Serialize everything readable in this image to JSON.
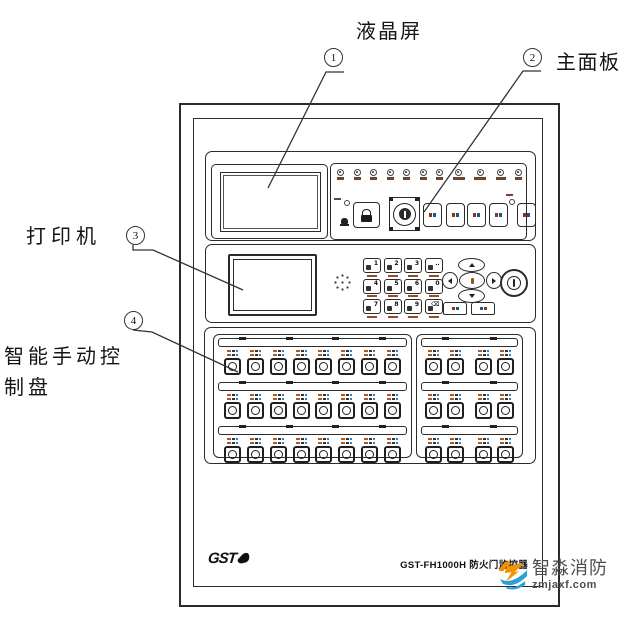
{
  "callouts": {
    "lcd": {
      "num": "1",
      "label": "液晶屏"
    },
    "main_panel": {
      "num": "2",
      "label": "主面板"
    },
    "printer": {
      "num": "3",
      "label": "打印机"
    },
    "manual": {
      "num": "4",
      "label_line1": "智能手动控",
      "label_line2": "制盘"
    }
  },
  "cabinet": {
    "brand": "GST",
    "model_label": "GST-FH1000H 防火门监控器",
    "main_panel": {
      "status_led_count": 11,
      "function_button_count": 5
    },
    "keypad": {
      "keys": [
        "1",
        "2",
        "3",
        "‥",
        "4",
        "5",
        "6",
        "0",
        "7",
        "8",
        "9",
        "⌫"
      ]
    },
    "manual_panel": {
      "left": {
        "rows": 3,
        "columns": 8,
        "tabs": 4
      },
      "right": {
        "rows": 3,
        "columns": 4,
        "tabs": 2
      }
    }
  },
  "watermark": {
    "brand": "智淼消防",
    "domain": "zmjaxf.com",
    "colors": {
      "orange": "#f29200",
      "blue": "#2b9fd8",
      "text": "#4d4d4f"
    }
  },
  "line_color": "#2b2b2b"
}
